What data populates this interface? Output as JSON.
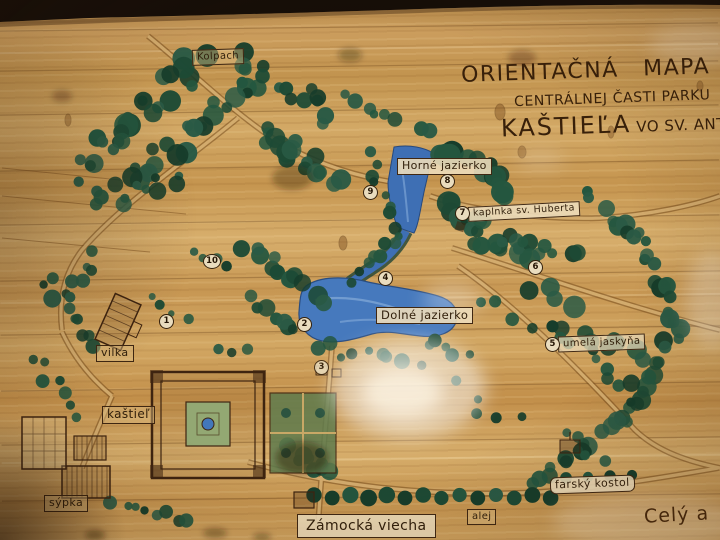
{
  "title": {
    "line1": "ORIENTAČNÁ MAPA",
    "line2": "CENTRÁLNEJ ČASTI PARKU",
    "line3_big": "KAŠTIEĽA",
    "line3_small": " VO SV. ANTONE"
  },
  "labels": {
    "kolpach": "Kolpach",
    "horne_jazierko": "Horné jazierko",
    "kaplnka": "kaplnka sv. Huberta",
    "dolne_jazierko": "Dolné jazierko",
    "umela_jaskyna": "umelá jaskyňa",
    "vilka": "vilka",
    "kastiel": "kaštieľ",
    "sypka": "sýpka",
    "farsky_kostol": "farský kostol",
    "zamocka_viecha": "Zámocká viecha",
    "alej": "alej",
    "cely": "Celý a"
  },
  "markers": [
    "1",
    "2",
    "3",
    "4",
    "5",
    "6",
    "7",
    "8",
    "9",
    "10"
  ],
  "colors": {
    "wood": "#c9995c",
    "tree_green": "#1d4a35",
    "lake_blue": "#4679bd",
    "ink": "#3a2310",
    "label_paper": "#e9dcbe"
  }
}
